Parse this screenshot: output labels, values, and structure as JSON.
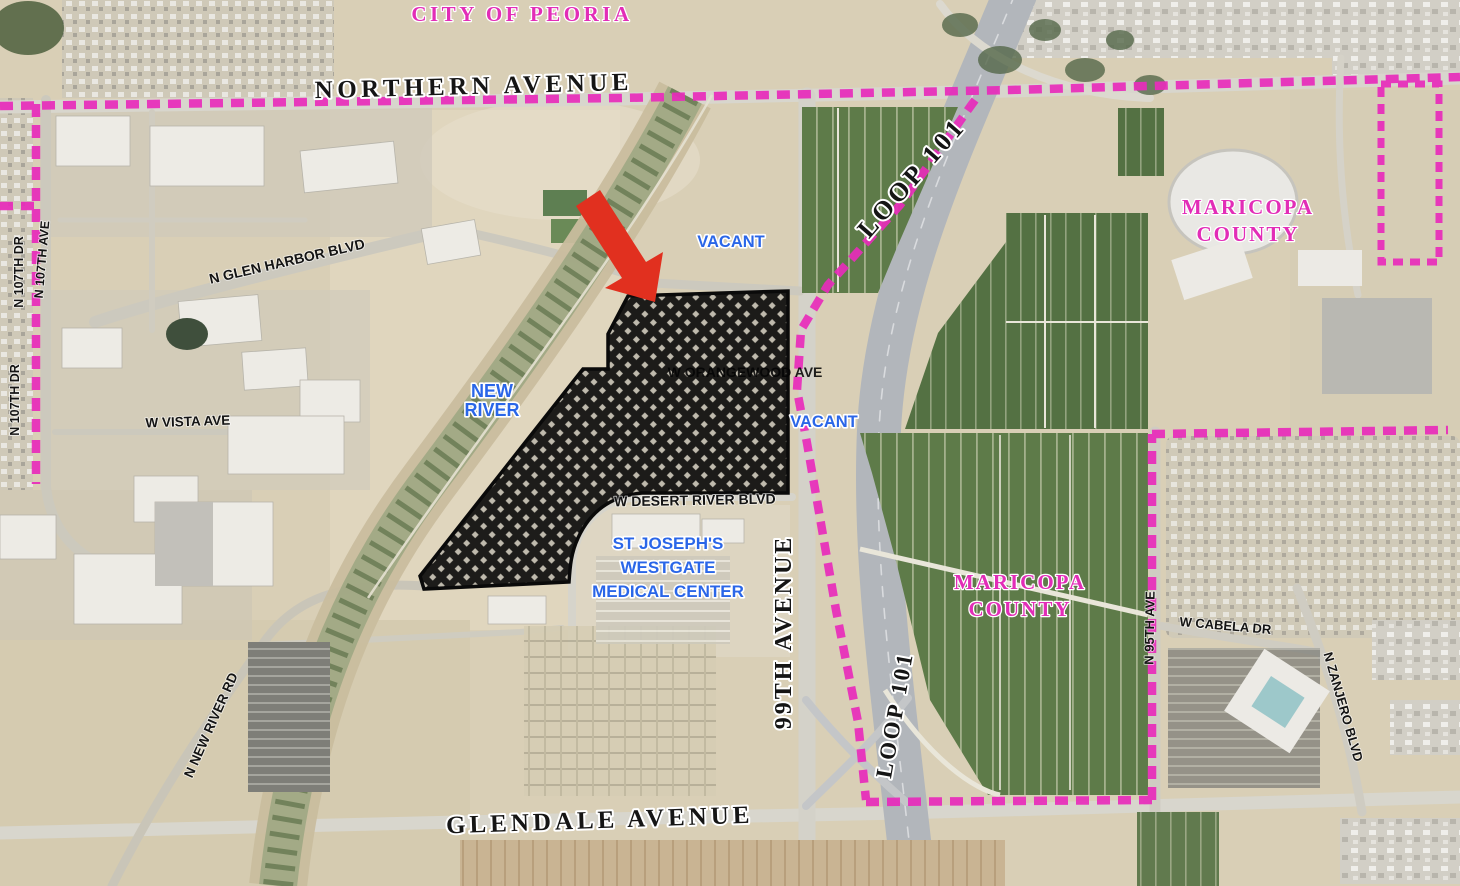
{
  "labels": {
    "city_of_peoria": "CITY OF PEORIA",
    "northern_avenue": "NORTHERN AVENUE",
    "glendale_avenue": "GLENDALE AVENUE",
    "ninety_ninth_avenue": "99TH AVENUE",
    "loop_101_upper": "LOOP 101",
    "loop_101_lower": "LOOP 101",
    "maricopa_county_upper": [
      "MARICOPA",
      "COUNTY"
    ],
    "maricopa_county_lower": [
      "MARICOPA",
      "COUNTY"
    ],
    "new_river": [
      "NEW",
      "RIVER"
    ],
    "vacant_north": "VACANT",
    "vacant_east": "VACANT",
    "st_josephs": [
      "ST JOSEPH'S",
      "WESTGATE",
      "MEDICAL CENTER"
    ],
    "glen_harbor_blvd": "N GLEN HARBOR BLVD",
    "vista_ave": "W VISTA AVE",
    "orangewood_ave": "W ORANGEWOOD AVE",
    "desert_river_blvd": "W DESERT RIVER BLVD",
    "new_river_rd": "N NEW RIVER RD",
    "dr_107_upper": "N 107TH DR",
    "ave_107": "N 107TH AVE",
    "dr_107_lower": "N 107TH DR",
    "ave_95": "N 95TH AVE",
    "cabela_dr": "W CABELA DR",
    "zanjero_blvd": "N ZANJERO BLVD"
  },
  "colors": {
    "boundary_magenta": "#e82bbb",
    "label_blue": "#2a66e8",
    "label_magenta": "#e22db7",
    "arrow_red": "#e1301f",
    "road_label_black": "#141414",
    "desert_tan": "#d9cfb6",
    "farm_green": "#5e7b49"
  }
}
